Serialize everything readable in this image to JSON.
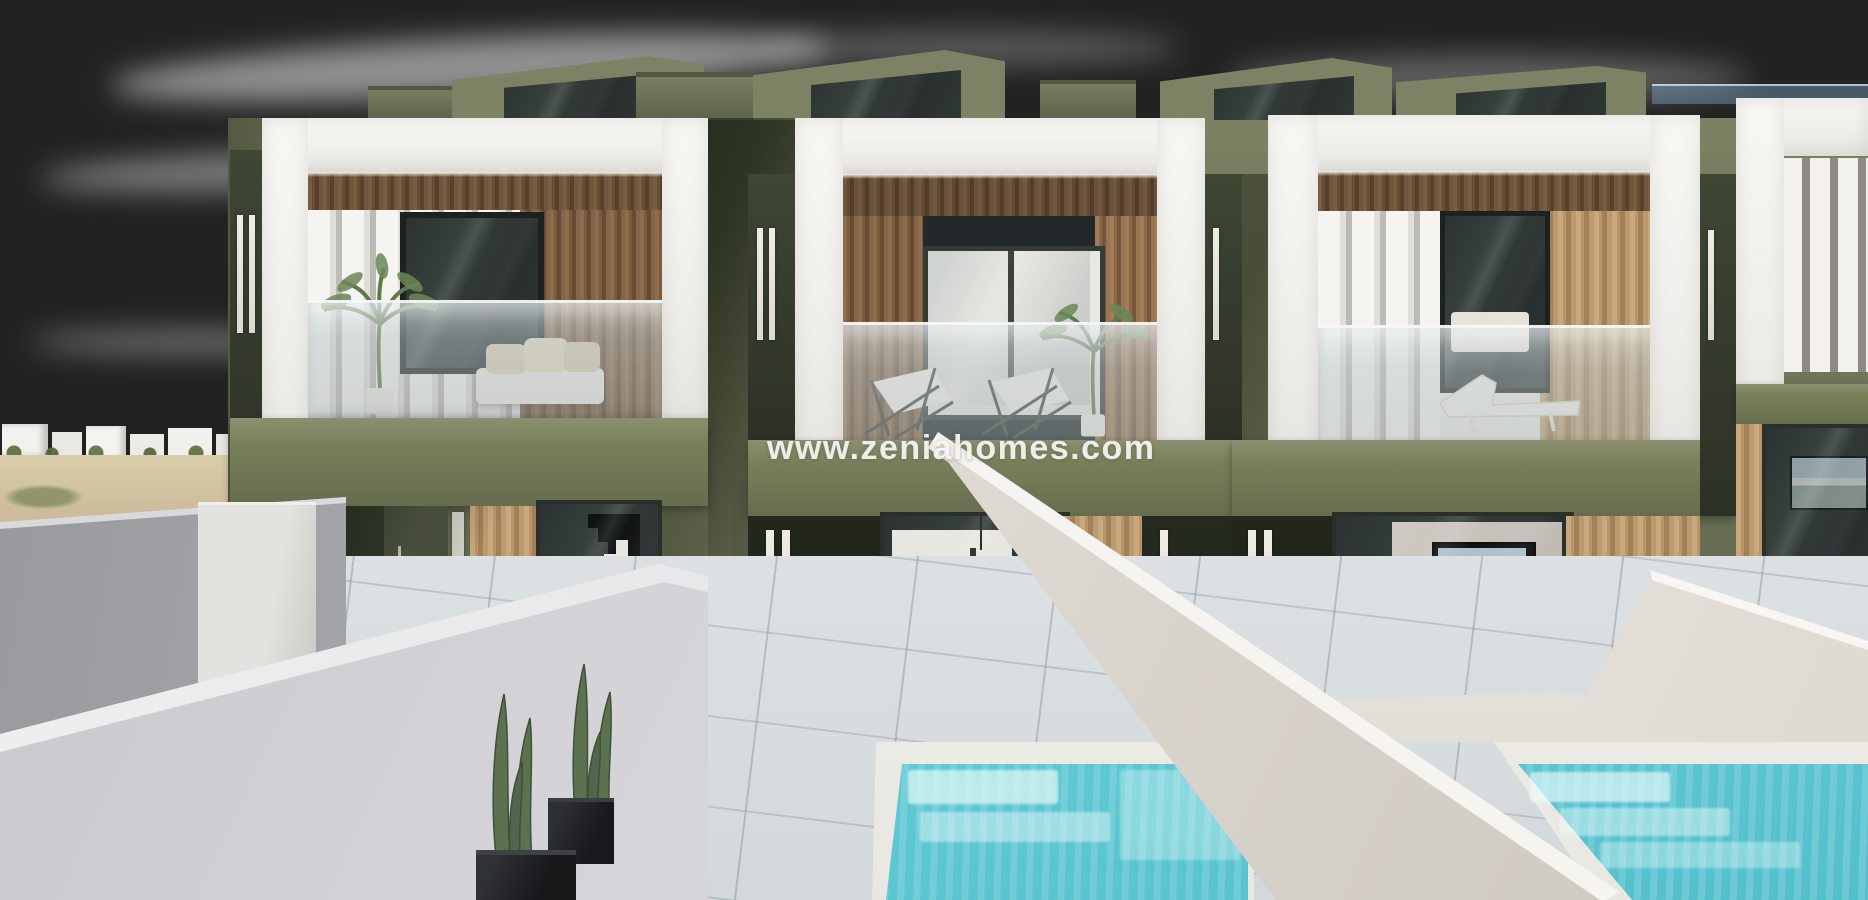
{
  "watermark": {
    "text": "www.zeniahomes.com",
    "color": "#f8f7f4"
  },
  "scene": {
    "kind": "architectural exterior render",
    "subject": "row of modern two-storey townhouses with private plunge pools",
    "objects": [
      "sky",
      "clouds",
      "distant white village",
      "scrub field",
      "olive-green party walls",
      "white balcony frames",
      "vertical wood slat cladding",
      "glass balustrades",
      "roof stair bulkheads",
      "balcony deck chairs",
      "balcony daybed",
      "palm plants",
      "ground floor glass sliders",
      "interior staircase",
      "interior kitchen and dining",
      "interior living room with TV",
      "outdoor designer dining set",
      "sun loungers",
      "wooden decks",
      "tiled patios",
      "turquoise plunge pools with steps",
      "white plot divider walls",
      "grey perimeter wall",
      "cacti in black planters",
      "watermark text"
    ]
  },
  "palette": {
    "sky_top": "#67a1d6",
    "sky_horizon": "#ecf2f6",
    "olive_wall": "#6b7154",
    "olive_dark": "#2c3125",
    "slab_olive": "#788059",
    "wood_light": "#b8956a",
    "wood_dark": "#7a5b3e",
    "white_frame": "#f5f4f0",
    "glass_dark": "#2b3231",
    "balustrade_glass": "rgba(186,197,199,0.5)",
    "tile": "#e0e4e6",
    "deck": "#b5946e",
    "pool_water": "#7fd7de",
    "pool_steps": "#ccf2ef",
    "coping": "#f1efea",
    "divider_wall": "#dddad5",
    "grey_wall": "#a7a8ac",
    "cactus": "#5b7150",
    "planter": "#1b1d20",
    "village_white": "#f1f0ec",
    "field": "#cdbc9b"
  }
}
